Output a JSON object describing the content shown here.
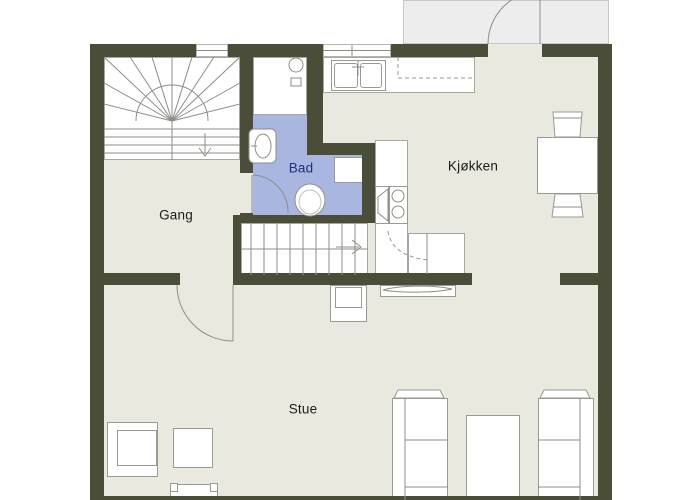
{
  "plan": {
    "rooms": {
      "gang": {
        "label": "Gang"
      },
      "bad": {
        "label": "Bad"
      },
      "kjokken": {
        "label": "Kjøkken"
      },
      "stue": {
        "label": "Stue"
      }
    },
    "colors": {
      "wall": "#4a4d38",
      "floor": "#e9e9df",
      "porch": "#ededed",
      "bathroom_fill": "#a9b7e0",
      "bathroom_label": "#1f2e7e",
      "label": "#1c1c1c",
      "outline": "#9a9a94",
      "background": "#ffffff"
    }
  }
}
